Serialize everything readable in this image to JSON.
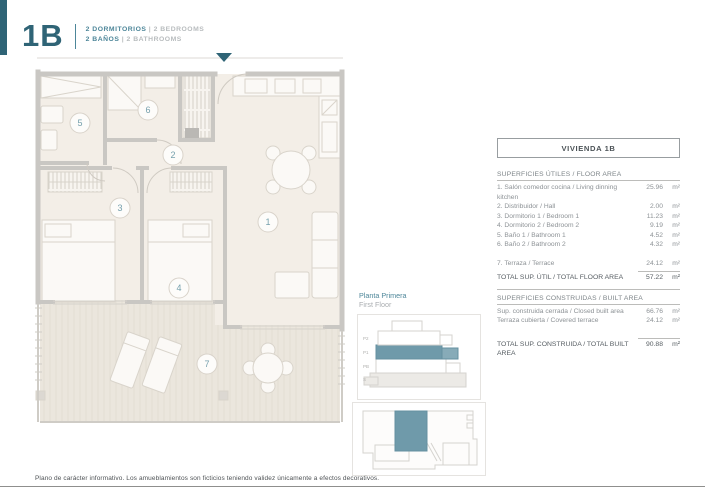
{
  "header": {
    "unit": "1B",
    "line1_es": "2 DORMITORIOS",
    "line1_en": "| 2 BEDROOMS",
    "line2_es": "2 BAÑOS",
    "line2_en": "| 2 BATHROOMS"
  },
  "plan": {
    "room_labels": [
      "1",
      "2",
      "3",
      "4",
      "5",
      "6",
      "7"
    ]
  },
  "panel": {
    "title": "VIVIENDA 1B",
    "floor_area": {
      "heading": "SUPERFICIES ÚTILES / FLOOR AREA",
      "rows": [
        {
          "label": "1. Salón comedor cocina / Living dinning kitchen",
          "value": "25.96",
          "unit": "m²"
        },
        {
          "label": "2. Distribuidor / Hall",
          "value": "2.00",
          "unit": "m²"
        },
        {
          "label": "3. Dormitorio 1 / Bedroom 1",
          "value": "11.23",
          "unit": "m²"
        },
        {
          "label": "4. Dormitorio 2 / Bedroom 2",
          "value": "9.19",
          "unit": "m²"
        },
        {
          "label": "5. Baño 1 / Bathroom 1",
          "value": "4.52",
          "unit": "m²"
        },
        {
          "label": "6. Baño 2 / Bathroom 2",
          "value": "4.32",
          "unit": "m²"
        }
      ],
      "terrace_row": {
        "label": "7. Terraza / Terrace",
        "value": "24.12",
        "unit": "m²"
      },
      "total": {
        "label": "TOTAL SUP. ÚTIL / TOTAL FLOOR AREA",
        "value": "57.22",
        "unit": "m²"
      }
    },
    "built_area": {
      "heading": "SUPERFICIES CONSTRUIDAS / BUILT AREA",
      "rows": [
        {
          "label": "Sup. construida cerrada / Closed built area",
          "value": "66.76",
          "unit": "m²"
        },
        {
          "label": "Terraza cubierta / Covered terrace",
          "value": "24.12",
          "unit": "m²"
        }
      ],
      "total": {
        "label": "TOTAL SUP. CONSTRUIDA /  TOTAL BUILT AREA",
        "value": "90.88",
        "unit": "m²"
      }
    }
  },
  "floor_key": {
    "title_es": "Planta Primera",
    "title_en": "First Floor",
    "levels": [
      "P2",
      "P1",
      "PB",
      "S"
    ]
  },
  "footer": {
    "note": "Plano de carácter informativo. Los amueblamientos son ficticios teniendo validez únicamente a efectos decorativos."
  },
  "colors": {
    "teal_dark": "#2f6476",
    "teal_accent": "#4d8699",
    "teal_fill": "#6f9aaa",
    "gray_text": "#8d9296",
    "light_gray_text": "#b8bcbe",
    "wall": "#c9c7c3",
    "floor": "#f3eee7",
    "terrace": "#ebe6dd"
  }
}
